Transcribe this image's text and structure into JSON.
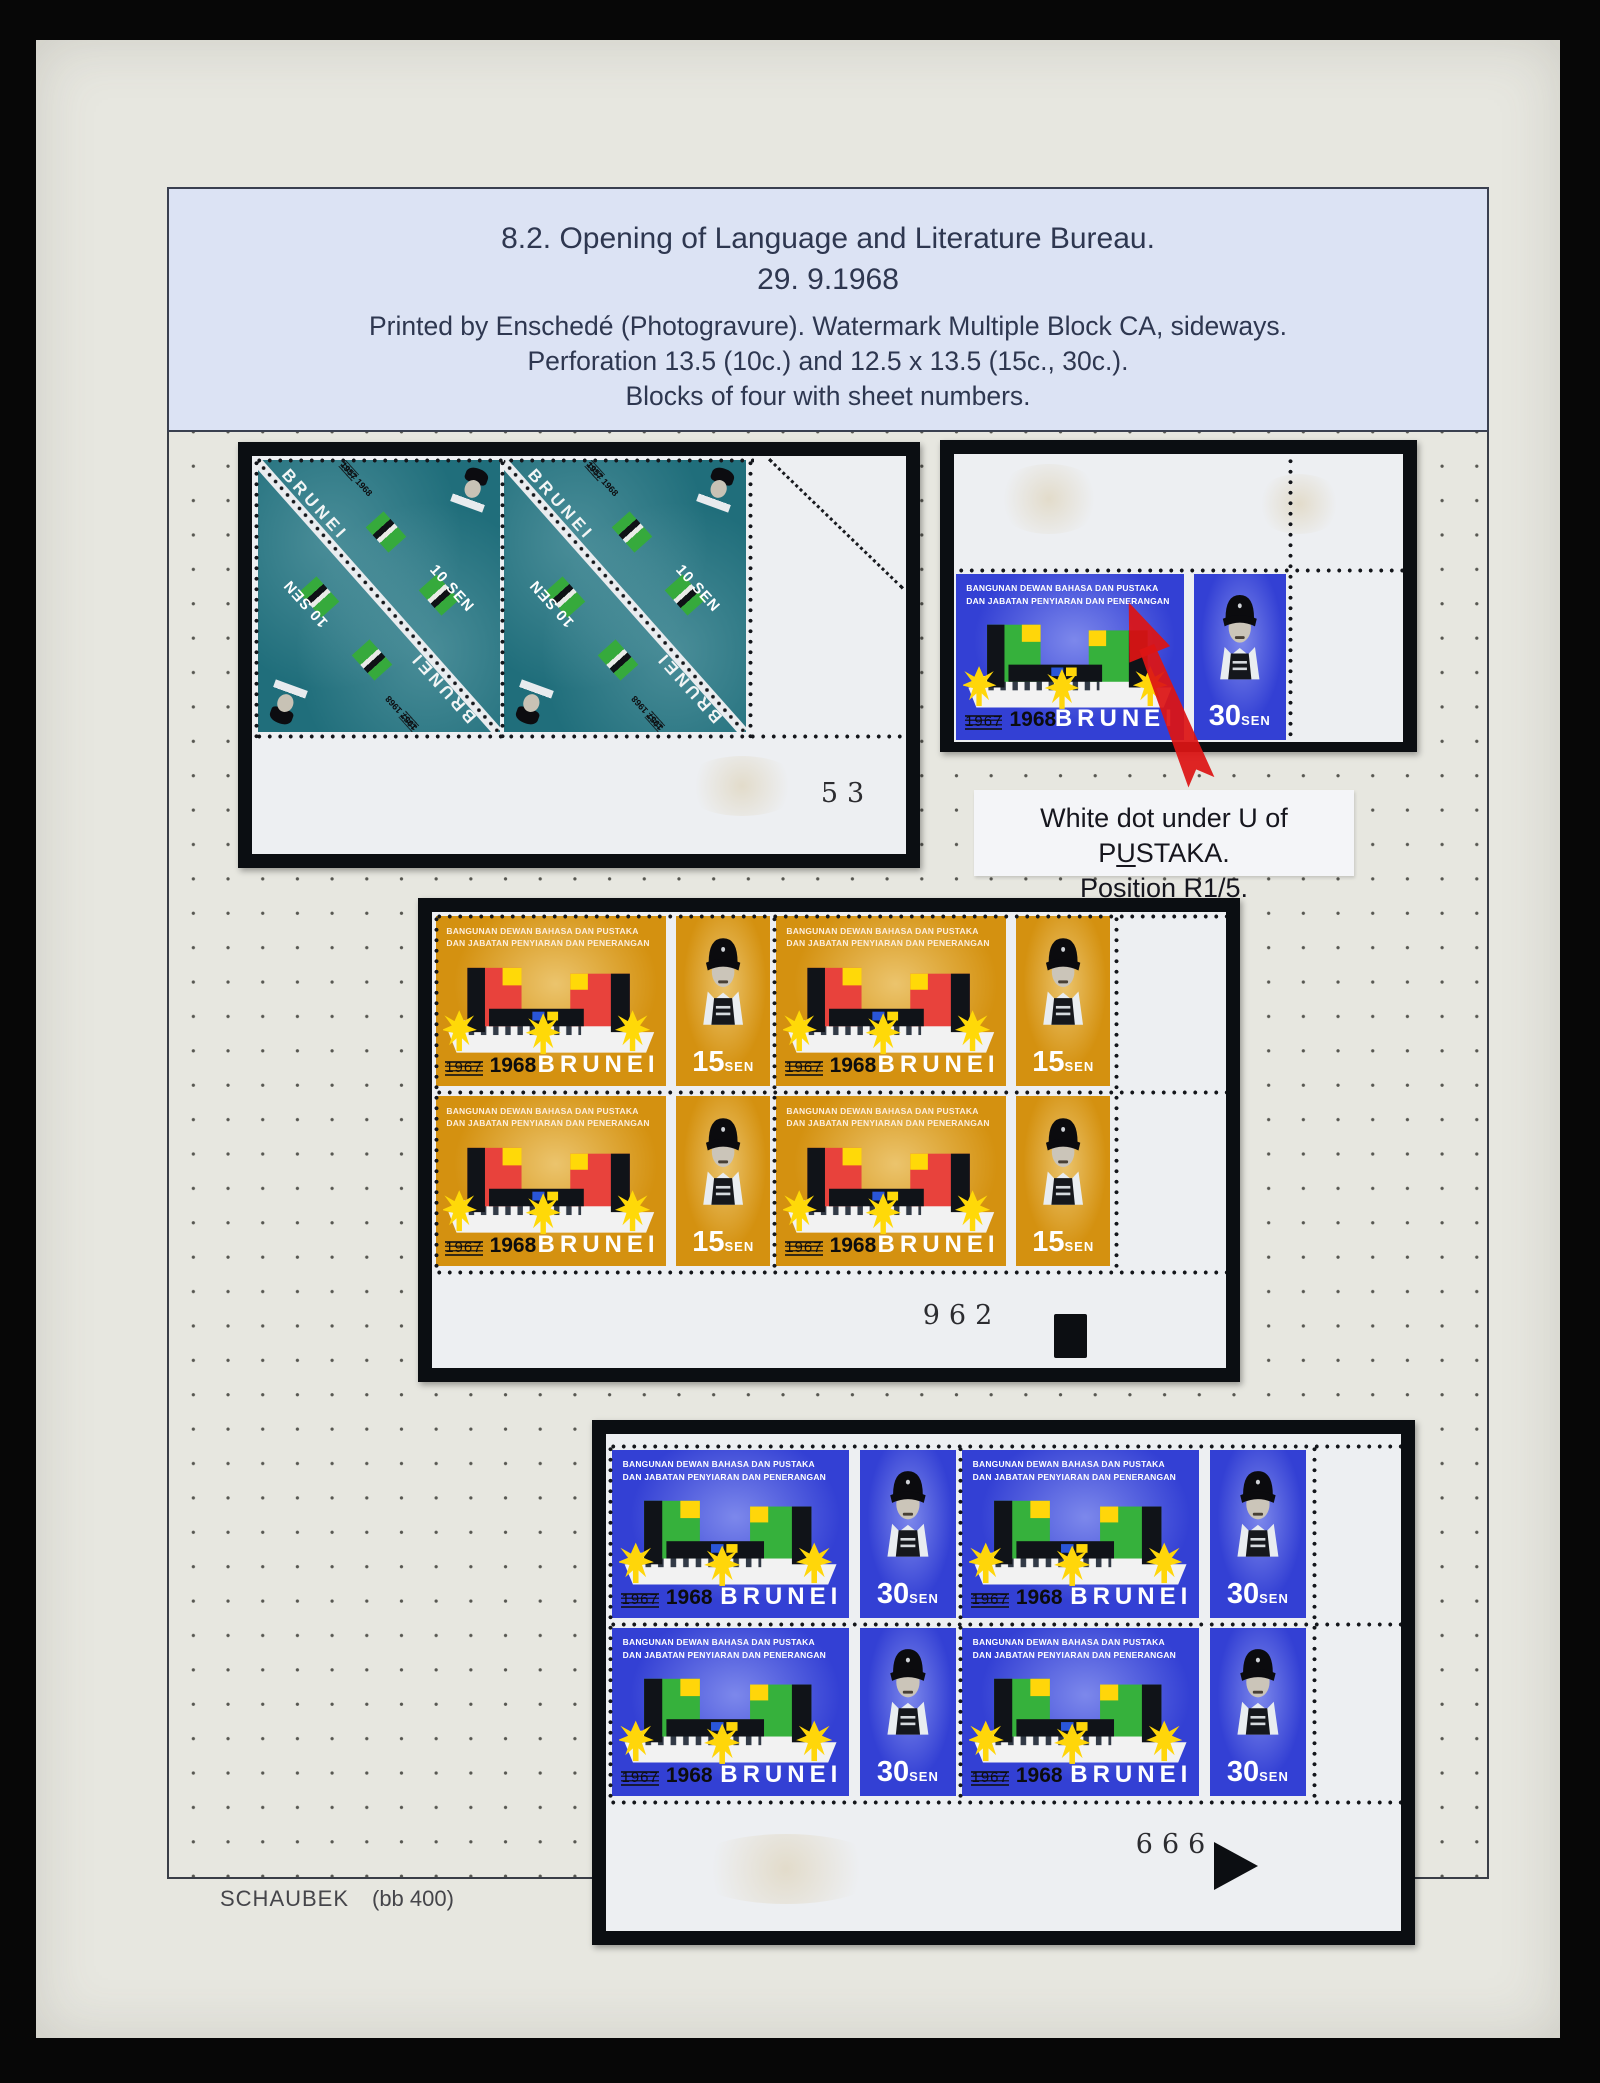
{
  "header": {
    "title": "8.2. Opening of Language and Literature Bureau.",
    "date": "29. 9.1968",
    "note1": "Printed by Enschedé (Photogravure). Watermark Multiple Block CA, sideways.",
    "note2": "Perforation 13.5 (10c.) and 12.5 x 13.5 (15c., 30c.).",
    "note3": "Blocks of four with sheet numbers."
  },
  "caption": {
    "line1_pre": "White dot under U of P",
    "line1_underlined": "U",
    "line1_post": "STAKA.",
    "line2": "Position R1/5."
  },
  "stamp_common": {
    "title1": "BANGUNAN DEWAN BAHASA DAN PUSTAKA",
    "title2": "DAN JABATAN PENYIARAN DAN PENERANGAN",
    "country": "BRUNEI",
    "year_old": "1967",
    "year_new": "1968",
    "sen": "SEN"
  },
  "values": {
    "v15": "15",
    "v30": "30"
  },
  "triangle_stamp": {
    "country": "BRUNEI",
    "value": "10 SEN",
    "year_old": "1957",
    "year_new": "1968"
  },
  "sheet_numbers": {
    "block_10c": "53",
    "block_15c": "962",
    "block_30c": "999"
  },
  "footer": {
    "publisher": "SCHAUBEK",
    "ref": "(bb 400)"
  },
  "colors": {
    "page": "#e7e7e0",
    "header_bg": "#dce3f4",
    "mount": "#0b0e12",
    "teal_10c": "#206e7b",
    "ochre_15c": "#d49110",
    "blue_30c": "#3340d4",
    "building_green": "#36b13c",
    "building_red": "#e8423c",
    "accent_yellow": "#ffd60a",
    "arrow_red": "#dd1414"
  }
}
